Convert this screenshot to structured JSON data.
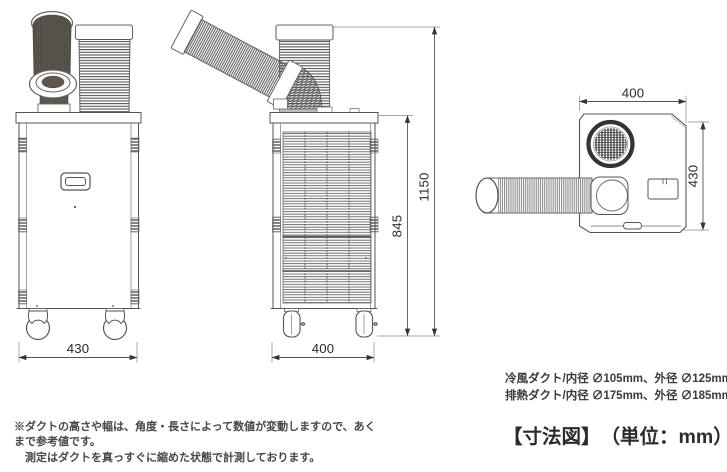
{
  "figure": {
    "title": "【寸法図】",
    "unit": "（単位：mm）"
  },
  "duct_specs": {
    "cold": "冷風ダクト/内径 ∅105mm、外径 ∅125mm",
    "exhaust": "排熱ダクト/内径 ∅175mm、外径 ∅185mm"
  },
  "footnote": {
    "line1": "※ダクトの高さや幅は、角度・長さによって数値が変動しますので、あくまで参考値です。",
    "line2": "測定はダクトを真っすぐに縮めた状態で計測しております。"
  },
  "dimensions": {
    "front_view": {
      "width": "430"
    },
    "side_view": {
      "depth": "400",
      "body_height": "845",
      "total_height": "1150"
    },
    "top_view": {
      "width": "400",
      "depth": "430"
    }
  },
  "colors": {
    "line": "#555555",
    "dark_duct": "#5d574f",
    "text": "#3a3a3a"
  }
}
